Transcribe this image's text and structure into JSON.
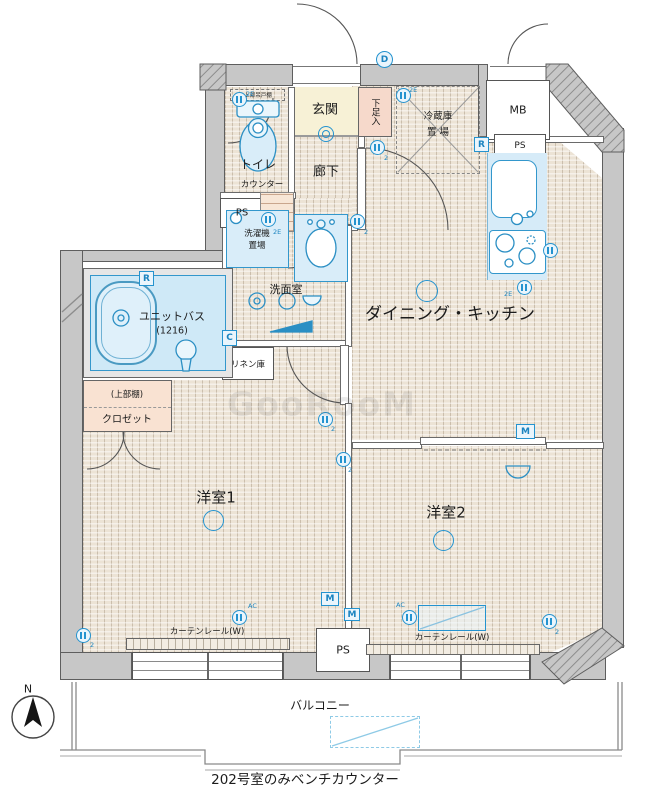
{
  "colors": {
    "accent_blue": "#2493cf",
    "wall_gray": "#c7c7c7",
    "floor_beige": "#ece3d5",
    "genkan_cream": "#f7f1d6",
    "closet_peach": "#f9e2d2",
    "fixture_blue": "#d9edf9"
  },
  "labels": {
    "dk": "ダイニング・キッチン",
    "room1": "洋室1",
    "room2": "洋室2",
    "genkan": "玄関",
    "corridor": "廊下",
    "toilet": "トイレ",
    "washroom": "洗面室",
    "unit_bath": "ユニットバス",
    "unit_bath_size": "(1216)",
    "balcony": "バルコニー",
    "shoe_box": "下足入",
    "closet": "クロゼット",
    "closet_upper": "(上部棚)",
    "linen": "リネン庫",
    "fridge_line1": "冷蔵庫",
    "fridge_line2": "置 場",
    "toilet_shelf": "上部吊戸棚",
    "laundry_line1": "洗濯機",
    "laundry_line2": "置場",
    "counter": "カウンター",
    "curtain_rail": "カーテンレール(W)",
    "mb": "MB",
    "ps": "PS",
    "note": "202号室のみベンチカウンター",
    "watermark": "GooRooM",
    "north": "N"
  },
  "markers": {
    "doorbell": "D",
    "multimedia": "M",
    "range": "R",
    "cold_water": "C",
    "outlet_2e": "2E",
    "outlet_2": "2",
    "outlet_ac": "AC"
  }
}
